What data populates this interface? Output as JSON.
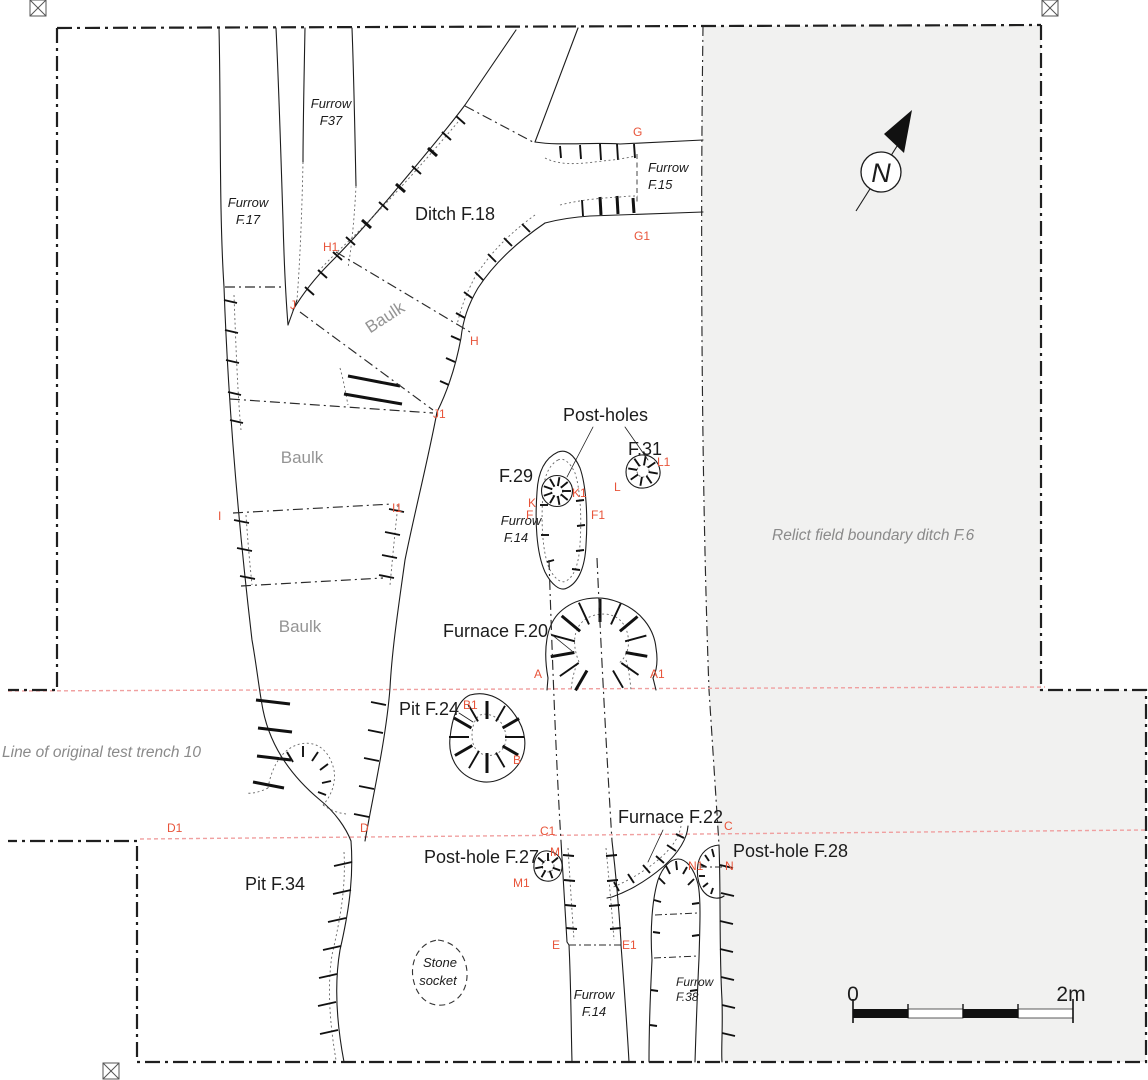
{
  "labels": {
    "features": {
      "ditch_f18": "Ditch F.18",
      "post_holes": "Post-holes",
      "f31": "F.31",
      "f29": "F.29",
      "furnace_f20": "Furnace F.20",
      "pit_f24": "Pit F.24",
      "furnace_f22": "Furnace F.22",
      "post_hole_f27": "Post-hole F.27",
      "post_hole_f28": "Post-hole F.28",
      "pit_f34": "Pit F.34"
    },
    "furrows": {
      "f37": {
        "line1": "Furrow",
        "line2": "F37"
      },
      "f17": {
        "line1": "Furrow",
        "line2": "F.17"
      },
      "f15": {
        "line1": "Furrow",
        "line2": "F.15"
      },
      "f14_upper": {
        "line1": "Furrow",
        "line2": "F.14"
      },
      "f14_lower": {
        "line1": "Furrow",
        "line2": "F.14"
      },
      "f38": {
        "line1": "Furrow",
        "line2": "F.38"
      },
      "stone_socket": {
        "line1": "Stone",
        "line2": "socket"
      }
    },
    "areas": {
      "baulk_upper": "Baulk",
      "baulk_middle": "Baulk",
      "baulk_lower": "Baulk",
      "relict_ditch": "Relict field boundary ditch F.6",
      "test_trench": "Line of original test trench 10"
    },
    "letters": {
      "g": "G",
      "g1": "G1",
      "h": "H",
      "h1": "H1",
      "j": "J",
      "j1": "J1",
      "i": "I",
      "i1": "I1",
      "k": "K",
      "k1": "K1",
      "f": "F",
      "f1": "F1",
      "l": "L",
      "l1": "L1",
      "a": "A",
      "a1": "A1",
      "b": "B",
      "b1": "B1",
      "c": "C",
      "c1": "C1",
      "d": "D",
      "d1": "D1",
      "e": "E",
      "e1": "E1",
      "m": "M",
      "m1": "M1",
      "n": "N",
      "n1": "N1"
    },
    "north": "N",
    "scale": {
      "zero": "0",
      "max": "2m"
    }
  },
  "colors": {
    "section_line": "#f0a0a0",
    "section_letter": "#e8543a",
    "relict_area_fill": "#f1f1f0",
    "gray_text": "#8a8a8a",
    "line": "#1c1c1c"
  }
}
